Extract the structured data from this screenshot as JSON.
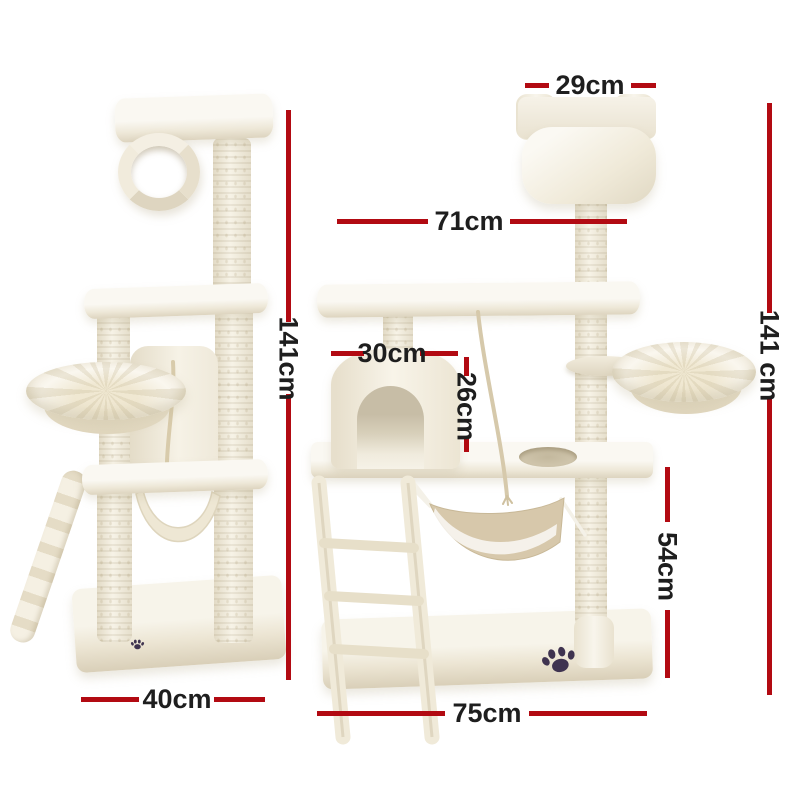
{
  "image_type": "product dimension diagram",
  "product": "cat tree scratching post tower",
  "views": {
    "left": "side view",
    "right": "front view"
  },
  "colors": {
    "dimension_line": "#b20a12",
    "label_text": "#1e1e1e",
    "fur": "#f2ede0",
    "fur_shadow": "#ddd4bf",
    "hammock_canvas": "#d7c8ab",
    "paw_print": "#3f3350",
    "background": "#ffffff"
  },
  "dimensions": {
    "top_box_width": "29cm",
    "platform_width": "71cm",
    "total_height_left": "141cm",
    "total_height_right": "141 cm",
    "condo_width": "30cm",
    "condo_height": "26cm",
    "lower_section_height": "54cm",
    "base_depth": "40cm",
    "base_width": "75cm"
  }
}
